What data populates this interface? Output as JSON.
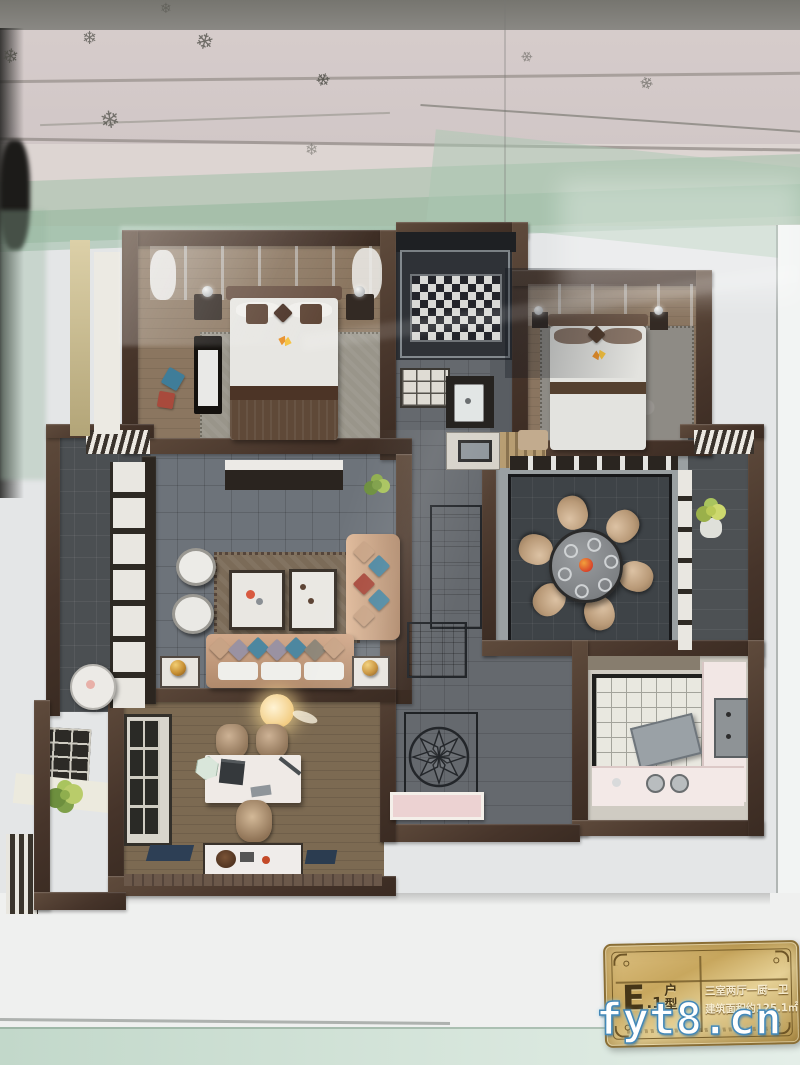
{
  "plaque": {
    "unit_letter": "E",
    "unit_suffix": ".1",
    "unit_type_label_top": "户",
    "unit_type_label_bottom": "型",
    "spec_line": "三室两厅一厨一卫",
    "area_line": "建筑面积约125.1㎡"
  },
  "watermark": {
    "text": "fyt8.cn"
  },
  "icons": {
    "snowflake": "❄"
  },
  "colors": {
    "wall_brown": "#4a392e",
    "plaque_gold": "#c7a45c",
    "glass_green": "#b7cfbd",
    "sofa_champagne": "#c9a286",
    "pillow_blue": "#4d87a0",
    "pillow_red": "#a84a3c",
    "tile_grey": "#6d737a",
    "dining_tile_dark": "#3e4347",
    "wood_floor": "#8b7660",
    "watermark_outline": "#4388b8",
    "backdrop": "#e4e6e7"
  }
}
